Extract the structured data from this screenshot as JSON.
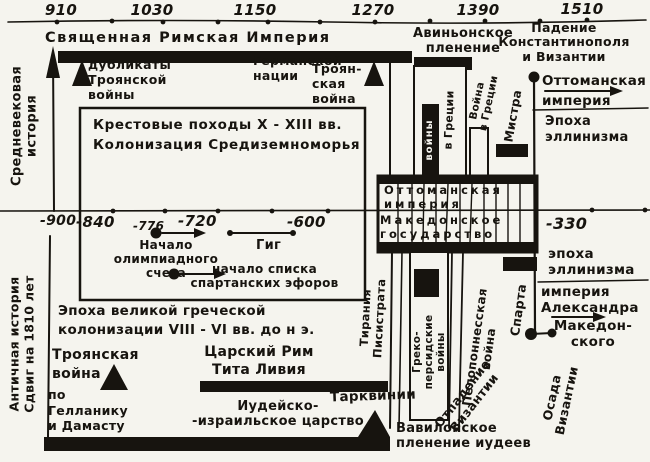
{
  "palette": {
    "paper": "#f5f4ee",
    "ink": "#17140f"
  },
  "top_axis": {
    "labels": [
      "910",
      "1030",
      "1150",
      "1270",
      "1390",
      "1510"
    ]
  },
  "mid_axis": {
    "labels": [
      "-900",
      "-840",
      "-776",
      "-720",
      "-600",
      "-330"
    ]
  },
  "sidebar": {
    "medieval": "Средневековая\nистория",
    "ancient": "Античная история\nСдвиг на 1810 лет"
  },
  "medieval": {
    "empire": "Священная Римская Империя",
    "duplicates": "дубликаты\nТроянской\nвойны",
    "german_nation": "Германской\nнации",
    "trojan_war": "Троян-\nская\nвойна",
    "crusades": "Крестовые походы X - XIII вв.\nКолонизация Средиземноморья",
    "avignon": "Авиньонское\nпленение",
    "fall_constantinople": "Падение\nКонстантинополя\nи Византии",
    "wars": "войны",
    "in_greece": "в Греции",
    "war_in_greece": "Война\nв Греции",
    "mistra": "Мистра",
    "ottoman": "Оттоманская\nимперия",
    "hellenism": "Эпоха\nэллинизма"
  },
  "parallel_box": {
    "ottoman": "Оттоманская\nимперия",
    "macedonian": "Македонское\nгосударство"
  },
  "ancient": {
    "olympiad": "Начало\nолимпиадного\nсчета",
    "gyges": "Гиг",
    "ephors": "начало списка\nспартанских эфоров",
    "colonization": "Эпоха великой греческой\nколонизации VIII - VI вв. до н э.",
    "trojan_war": "Троянская\nвойна",
    "by_hellanicus": "по\nГелланику\nи Дамасту",
    "regal_rome": "Царский Рим\nТита Ливия",
    "tarquins": "Тарквинии",
    "judean_kingdom": "Иудейско-\n-израильское царство",
    "babylon_captivity": "Вавилонское\nпленение иудеев",
    "tyranny": "Тирания\nПисистрата",
    "greco_persian": "Греко-\nперсидские\nвойны",
    "peloponnesian": "Пелопоннесская\nвойна",
    "sparta": "Спарта",
    "secession": "Отпадение\nВизантии",
    "siege": "Осада\nВизантии",
    "hellenism": "эпоха\nэллинизма",
    "alexander": "империя\nАлександра",
    "of_macedon": "Македон-\nского"
  }
}
